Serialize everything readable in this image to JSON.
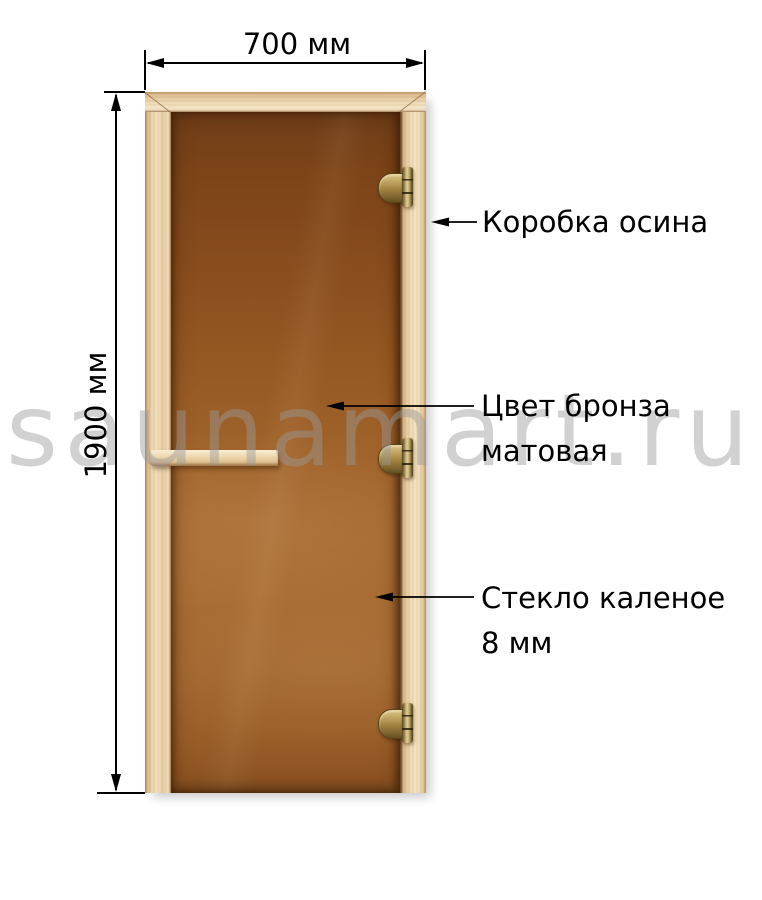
{
  "watermark": {
    "text": "saunamart.ru",
    "color": "#bdbdbd"
  },
  "dimensions": {
    "width": {
      "label": "700 мм"
    },
    "height": {
      "label": "1900 мм"
    }
  },
  "callouts": {
    "frame": {
      "label": "Коробка осина"
    },
    "glass_color": {
      "line1": "Цвет бронза",
      "line2": "матовая"
    },
    "glass_type": {
      "line1": "Стекло каленое",
      "line2": "8 мм"
    }
  },
  "door": {
    "frame_wood_color": "#ecd5ad",
    "glass_bronze_color": "#9a5e28",
    "hinge_brass_color": "#a98f52",
    "hinge_count": 3,
    "annotation_color": "#000000"
  }
}
